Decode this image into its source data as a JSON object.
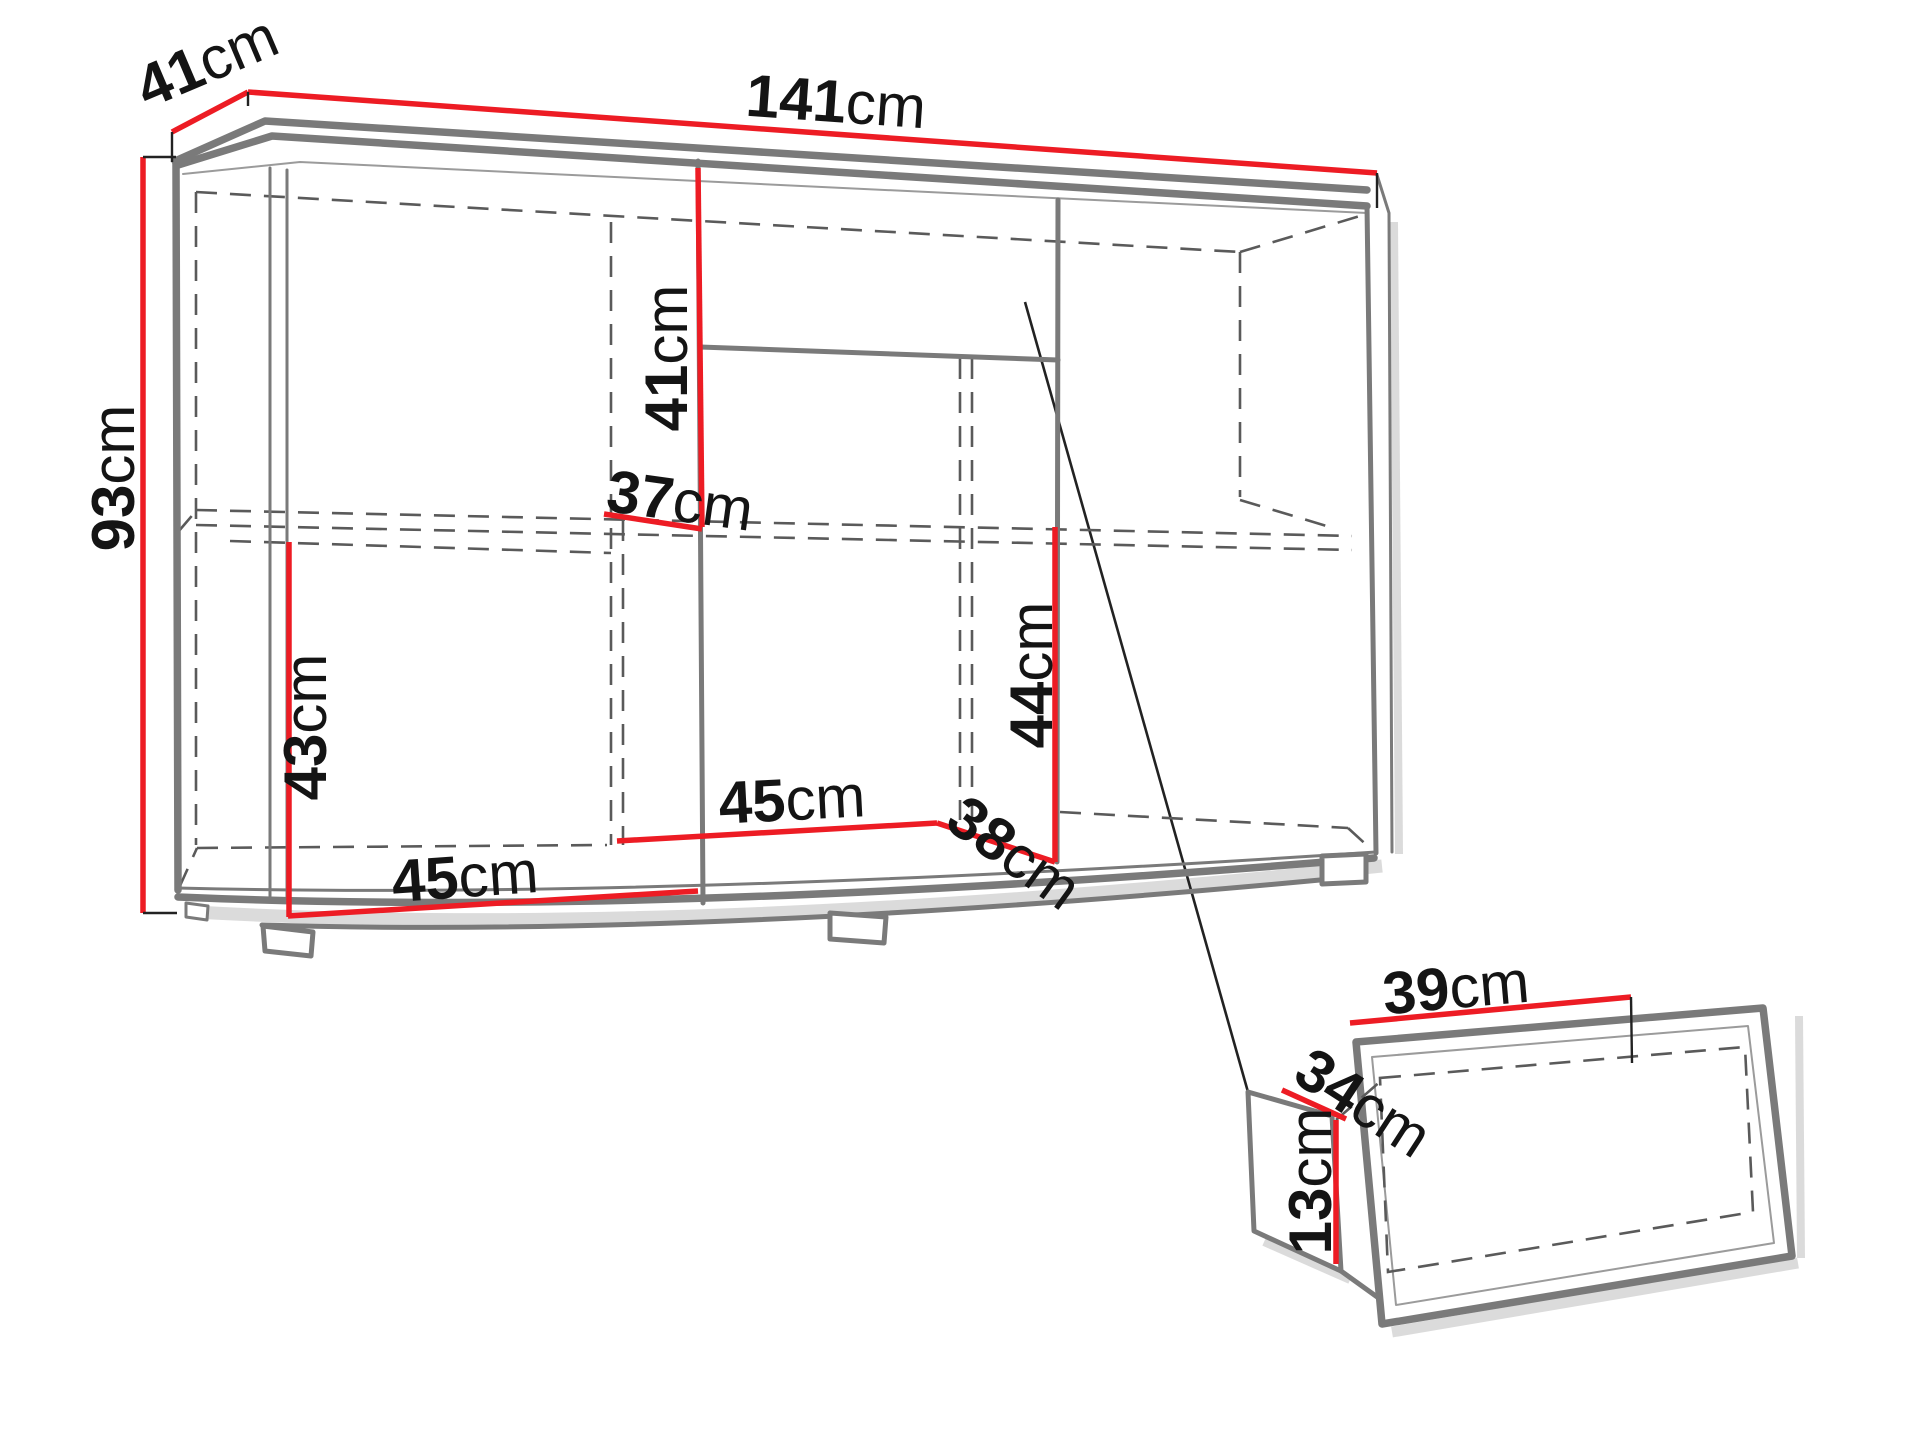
{
  "diagram": {
    "type": "furniture-dimension-diagram",
    "unit": "cm",
    "colors": {
      "dimension_line": "#ed1c24",
      "outline": "#7a7a7a",
      "hidden_line": "#5a5a5a",
      "label_text": "#141414"
    },
    "main_cabinet": {
      "width": {
        "num": "141",
        "unit": "cm"
      },
      "depth": {
        "num": "41",
        "unit": "cm"
      },
      "height": {
        "num": "93",
        "unit": "cm"
      },
      "middle_top_section_height": {
        "num": "41",
        "unit": "cm"
      },
      "shelf_depth": {
        "num": "37",
        "unit": "cm"
      },
      "left_section_lower_height": {
        "num": "43",
        "unit": "cm"
      },
      "left_section_width": {
        "num": "45",
        "unit": "cm"
      },
      "middle_section_width": {
        "num": "45",
        "unit": "cm"
      },
      "right_section_width": {
        "num": "38",
        "unit": "cm"
      },
      "right_section_lower_height": {
        "num": "44",
        "unit": "cm"
      }
    },
    "drawer": {
      "width": {
        "num": "39",
        "unit": "cm"
      },
      "depth": {
        "num": "34",
        "unit": "cm"
      },
      "height": {
        "num": "13",
        "unit": "cm"
      }
    }
  }
}
